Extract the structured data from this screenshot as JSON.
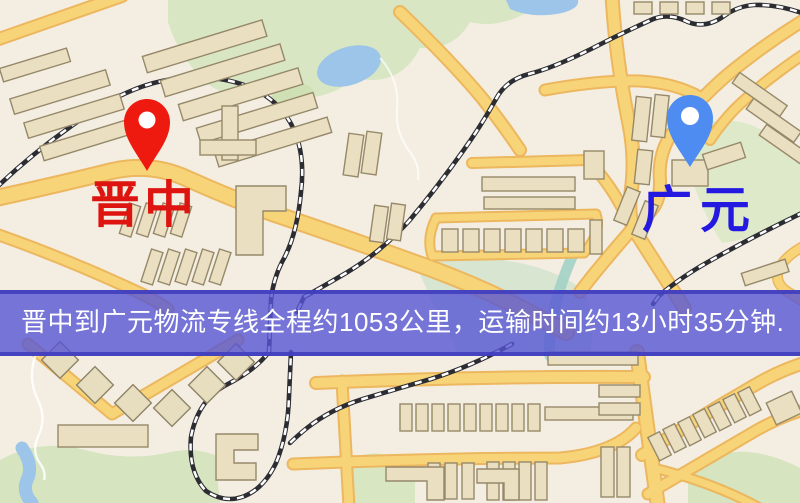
{
  "map": {
    "origin": {
      "label": "晋中",
      "pin_color": "#ef1a0f",
      "label_color": "#dd1410"
    },
    "destination": {
      "label": "广元",
      "pin_color": "#4f8cf2",
      "label_color": "#2419e0"
    }
  },
  "banner": {
    "text": "晋中到广元物流专线全程约1053公里，运输时间约13小时35分钟.",
    "from": "晋中",
    "to": "广元",
    "distance": "约1053公里",
    "duration": "约13小时35分钟",
    "text_color": "#ffffff",
    "background_color": "rgba(86,85,213,0.8)"
  },
  "map_colors": {
    "background": "#f4eee2",
    "road_fill": "#f8d478",
    "road_casing": "#ecb75e",
    "building": "#eadfc1",
    "park": "#d8e6c3",
    "water": "#9dc4e9",
    "railway": "#2c2c33"
  }
}
